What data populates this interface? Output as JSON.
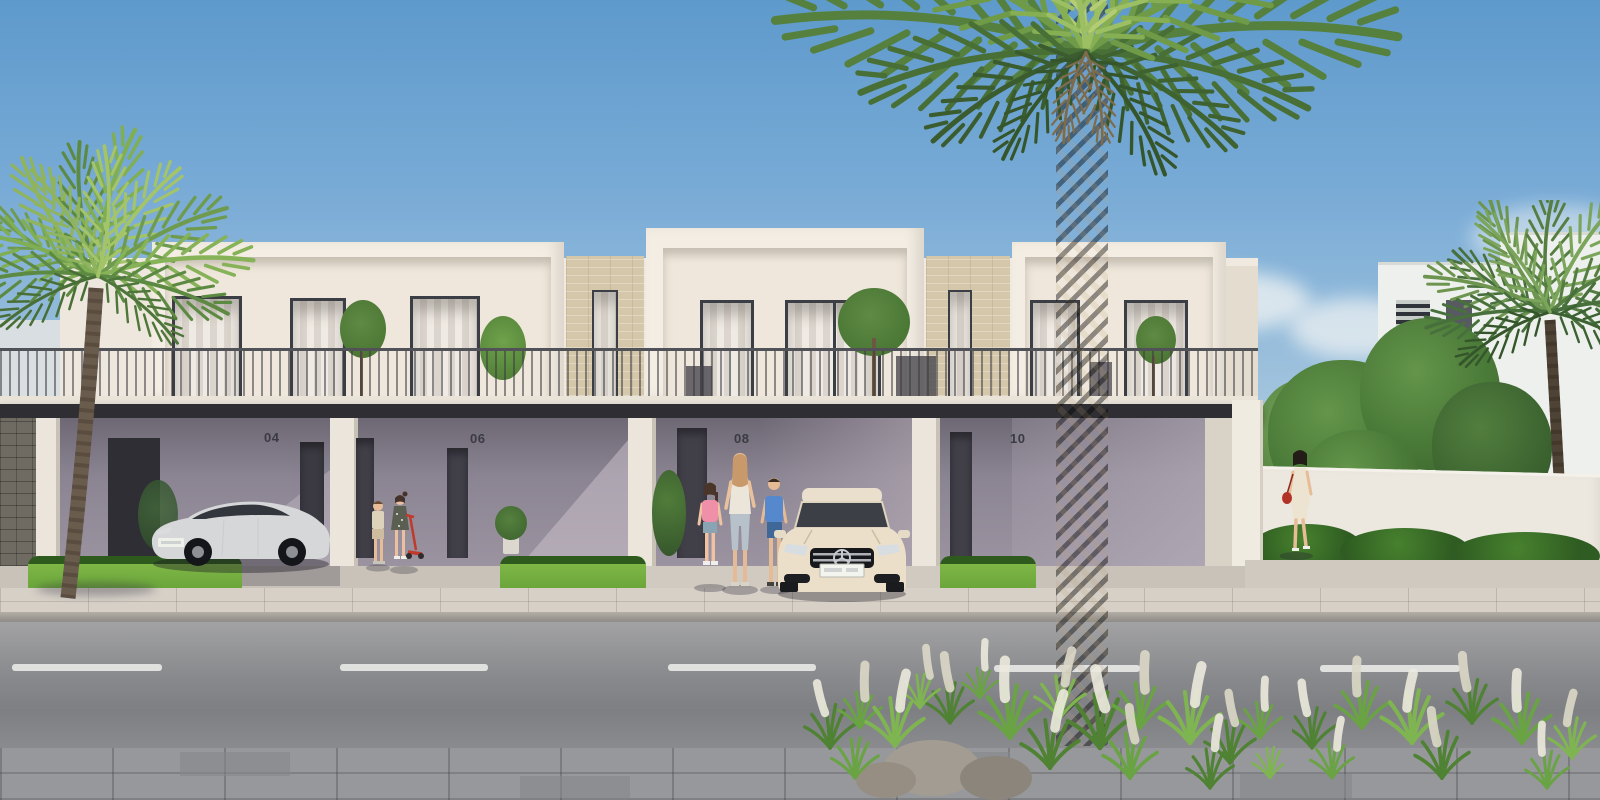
{
  "scene": {
    "title": "Modern townhouse street — sunny exterior visualisation",
    "description": "Photorealistic rendering of a row of two-storey white townhouses with ground-floor carports, continuous balcony railing, palm trees, parked cars, children and adults on the sidewalk",
    "setting": "daytime, clear blue sky"
  },
  "houses": [
    {
      "number": "04",
      "label": "townhouse unit 04"
    },
    {
      "number": "06",
      "label": "townhouse unit 06"
    },
    {
      "number": "08",
      "label": "townhouse unit 08"
    },
    {
      "number": "10",
      "label": "townhouse unit 10"
    }
  ],
  "vehicles": [
    {
      "name": "white sedan",
      "location": "parked in shaded carport of unit 04"
    },
    {
      "name": "cream coupe",
      "location": "parked on sunlit driveway of unit 08"
    }
  ],
  "people": [
    {
      "name": "woman with two children wearing backpacks",
      "location": "walking toward unit 08 entrance"
    },
    {
      "name": "two children with red kick scooter",
      "location": "porch of unit 06"
    },
    {
      "name": "woman in cream dress with red handbag",
      "location": "sidewalk at far right"
    }
  ],
  "vegetation": {
    "palms": [
      "left foreground palm",
      "large central palm",
      "far right palm"
    ],
    "other": [
      "balcony olive trees",
      "fountain grass clusters",
      "garden trees behind boundary wall",
      "hedges"
    ]
  },
  "colors": {
    "sky_top": "#5e9acc",
    "sky_horizon": "#e7e9e8",
    "facade_white": "#f2ece2",
    "stone_beige": "#d5c7aa",
    "canopy_dark": "#2f2e32",
    "ground_floor_shade": "#8b8492",
    "grass_green": "#74ad3f",
    "hedge_green": "#2e5a1e",
    "road_asphalt": "#88898c",
    "sidewalk": "#d6d0c7",
    "palm_frond": "#6f9b4e",
    "backpack_pink": "#ef8fa8",
    "backpack_blue": "#5588cc",
    "scooter_red": "#c03a2c",
    "handbag_red": "#b23228"
  }
}
